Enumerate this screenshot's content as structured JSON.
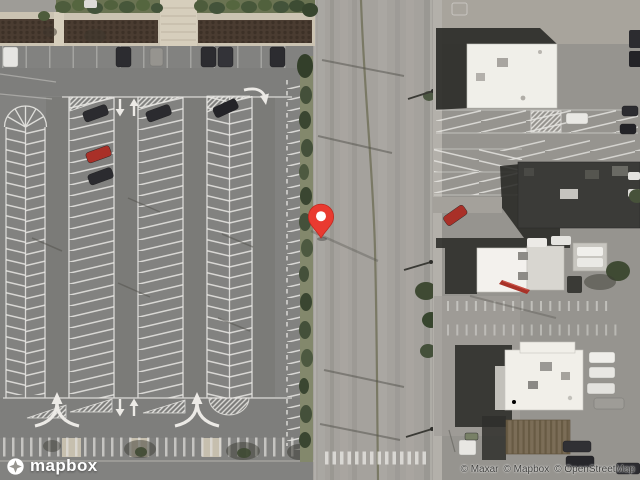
{
  "map": {
    "view": "satellite",
    "marker": {
      "color": "#e93a30",
      "anchor_x": 321,
      "anchor_y": 238
    }
  },
  "branding": {
    "logo_text": "mapbox"
  },
  "attribution": {
    "items": [
      "© Maxar",
      "© Mapbox",
      "© OpenStreetMap"
    ]
  }
}
